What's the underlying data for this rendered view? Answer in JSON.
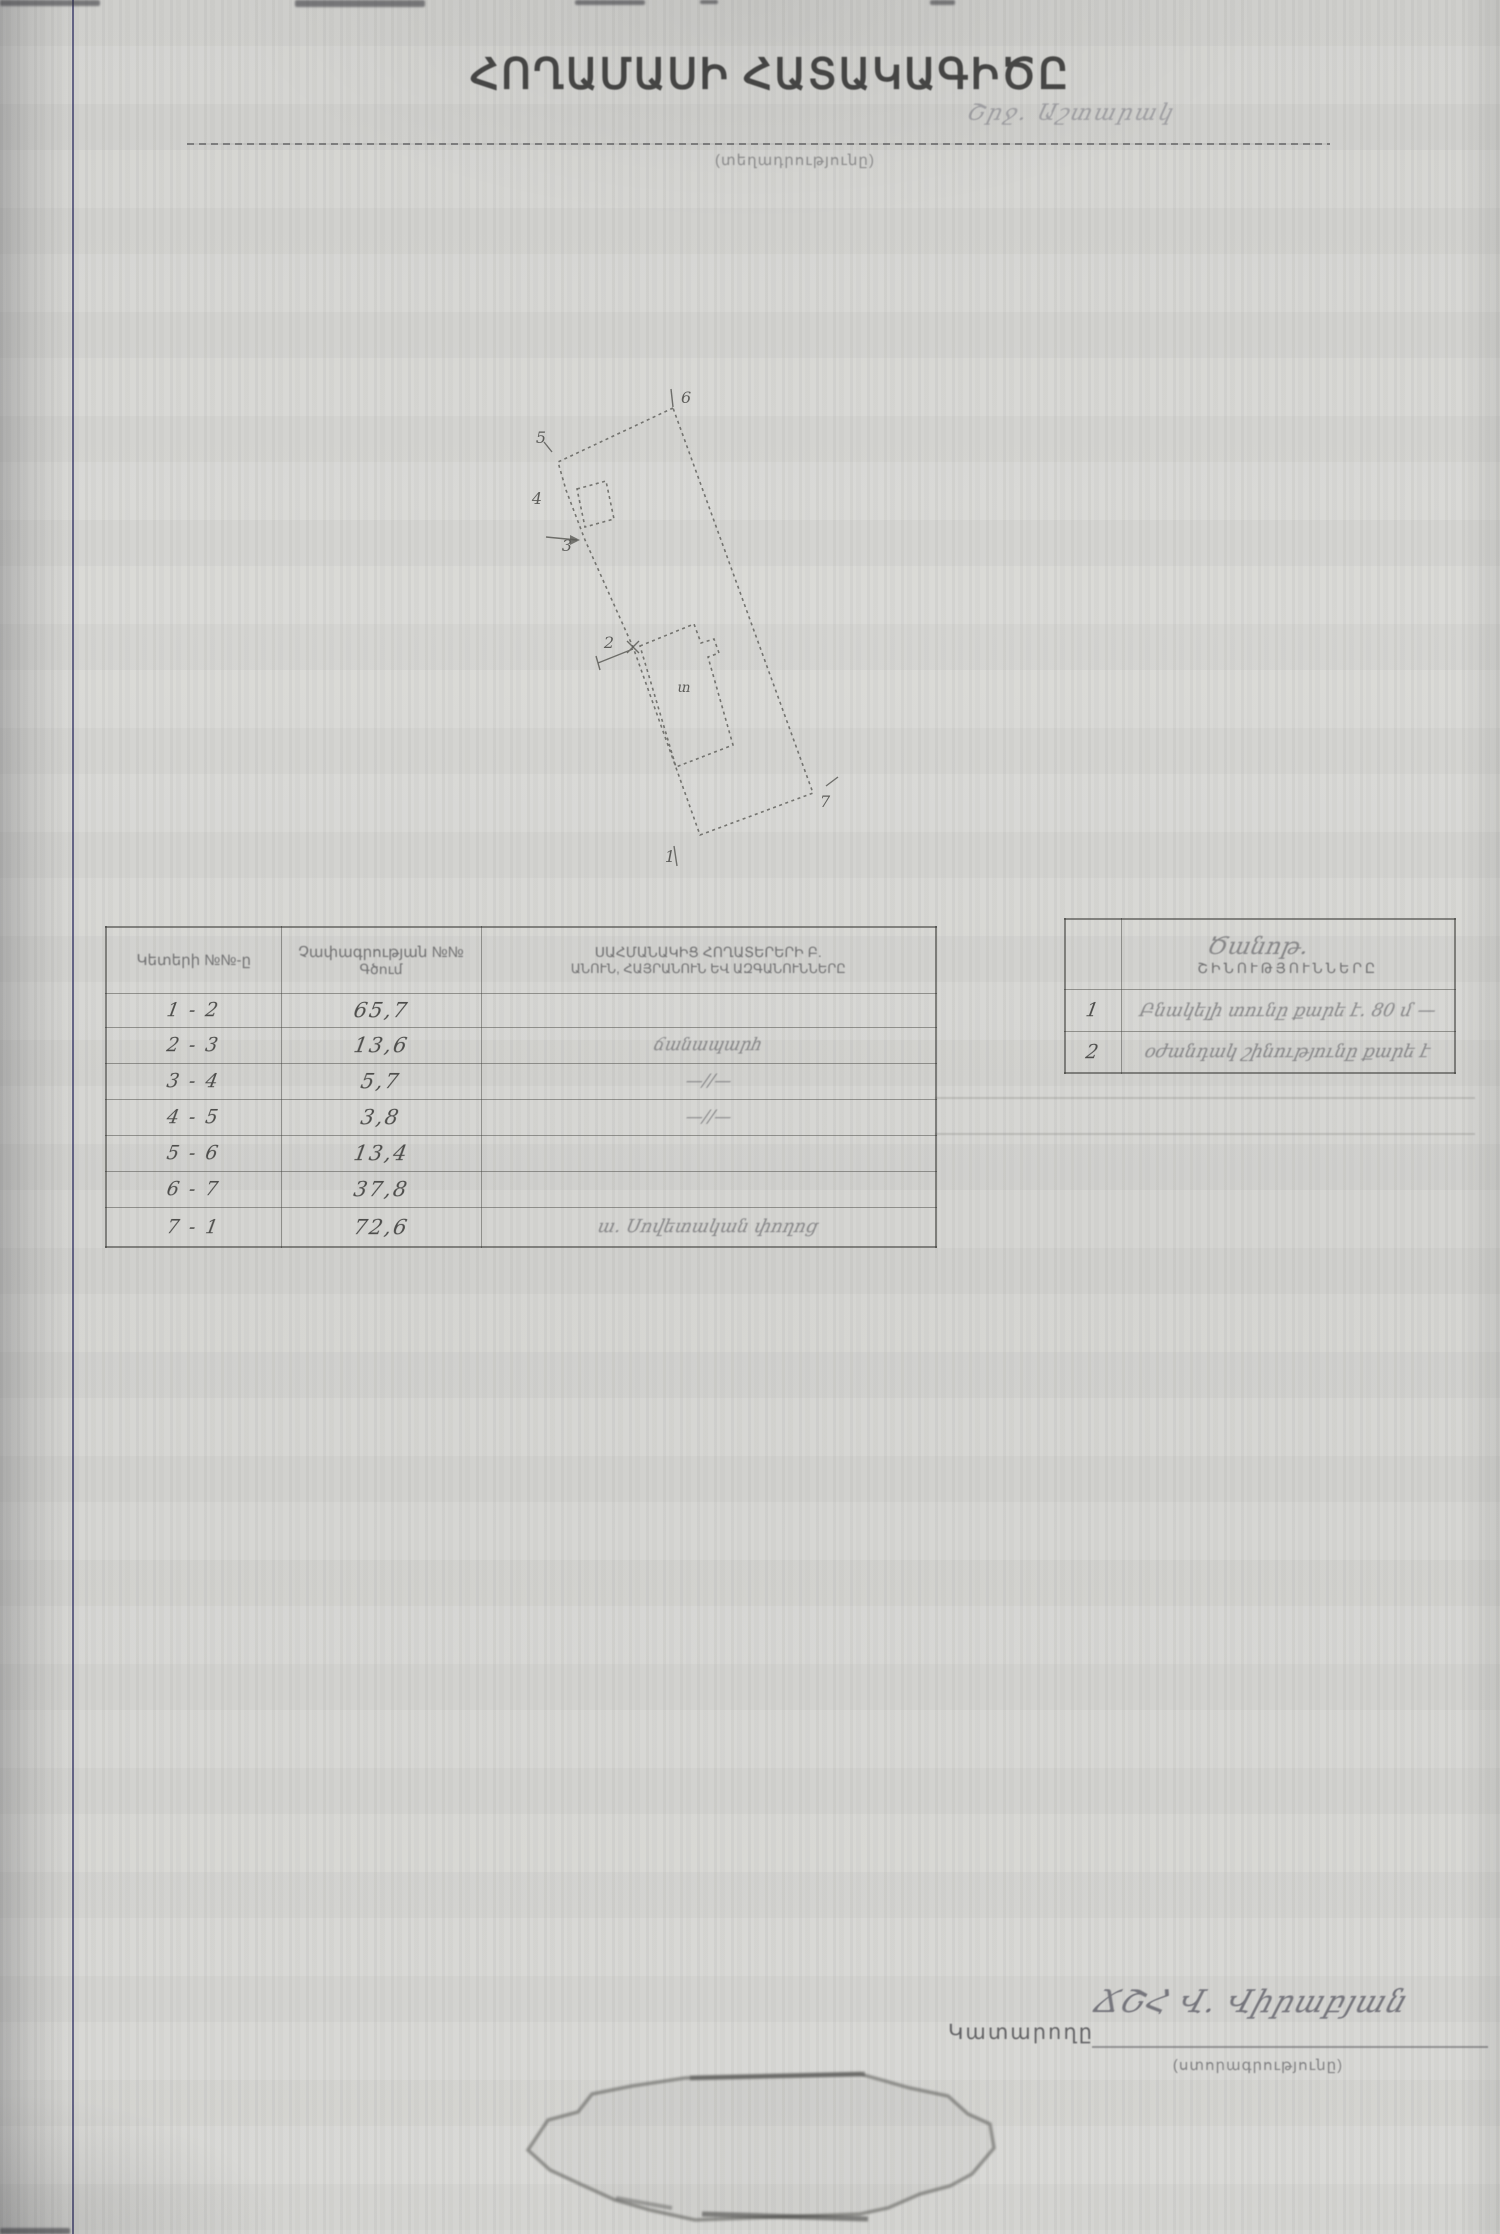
{
  "document": {
    "title": "ՀՈՂԱՄԱՍԻ ՀԱՏԱԿԱԳԻԾԸ",
    "region_note": "Շրջ. Աշտարակ",
    "location_caption": "(տեղադրությունը)"
  },
  "diagram": {
    "vertex_labels": [
      "1",
      "2",
      "3",
      "4",
      "5",
      "6",
      "7"
    ],
    "building_label": "տ"
  },
  "measurements_table": {
    "headers": {
      "points": "Կետերի №№-ը",
      "length_line1": "Չափագրության №№",
      "length_line2": "Գծում",
      "neighbors_line1": "ՍԱՀՄԱՆԱԿԻՑ ՀՈՂԱՏԵՐԵՐԻ Բ.",
      "neighbors_line2": "ԱՆՈՒՆ, ՀԱՅՐԱՆՈՒՆ ԵՎ ԱԶԳԱՆՈՒՆՆԵՐԸ"
    },
    "rows": [
      {
        "points": "1 - 2",
        "length": "65,7",
        "neighbor": ""
      },
      {
        "points": "2 - 3",
        "length": "13,6",
        "neighbor": "ճանապարհ"
      },
      {
        "points": "3 - 4",
        "length": "5,7",
        "neighbor": "—//—"
      },
      {
        "points": "4 - 5",
        "length": "3,8",
        "neighbor": "—//—"
      },
      {
        "points": "5 - 6",
        "length": "13,4",
        "neighbor": ""
      },
      {
        "points": "6 - 7",
        "length": "37,8",
        "neighbor": ""
      },
      {
        "points": "7 - 1",
        "length": "72,6",
        "neighbor": "ա. Սովետական փողոց"
      }
    ]
  },
  "notes_table": {
    "header_line1": "Ծանոթ.",
    "header_line2": "ՇԻՆՈՒԹՅՈՒՆՆԵՐԸ",
    "rows": [
      {
        "no": "1",
        "text": "Բնակելի տունը քարե է. 80 մ —"
      },
      {
        "no": "2",
        "text": "օժանդակ շինությունը քարե է"
      }
    ]
  },
  "signature": {
    "label": "Կատարողը",
    "signature_text": "ՃՇՀ  Վ. Վիրաբյան",
    "caption": "(ստորագրությունը)"
  }
}
